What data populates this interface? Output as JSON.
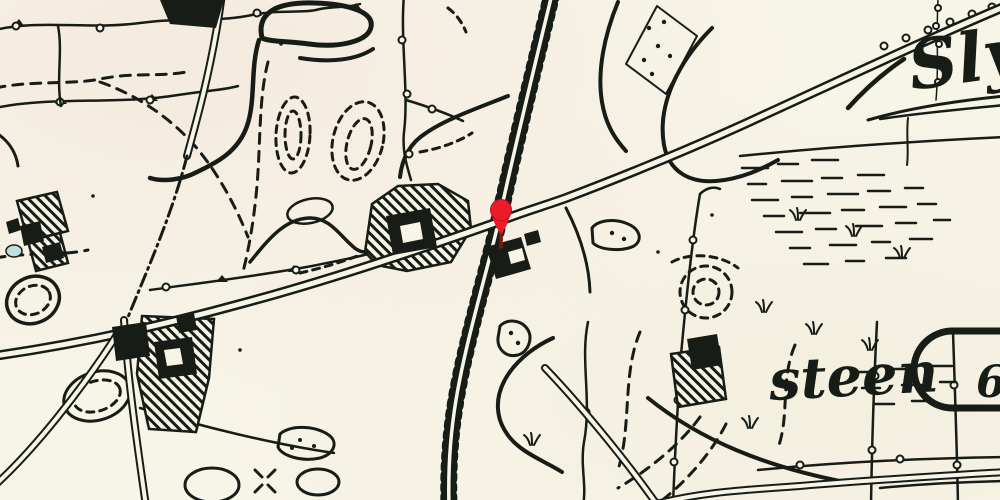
{
  "map": {
    "type": "historical-topographic-map",
    "labels": {
      "place_top_right": "Sly",
      "place_bottom_right": "steen",
      "parcel_cartouche": "6"
    },
    "marker": {
      "symbol": "location-pin"
    },
    "colors": {
      "paper": "#f7f4e8",
      "ink": "#171d16",
      "pin": "#ec1b2a",
      "pin-stem": "#7c1a12",
      "pond": "#bfe0de"
    },
    "features": [
      "railway-track",
      "main-road",
      "country-roads",
      "field-trail",
      "contour-lines",
      "field-boundaries",
      "hatched-farmsteads",
      "buildings",
      "ponds",
      "marsh-symbols",
      "vegetation-tufts",
      "parcel-cartouche",
      "location-pin"
    ]
  }
}
